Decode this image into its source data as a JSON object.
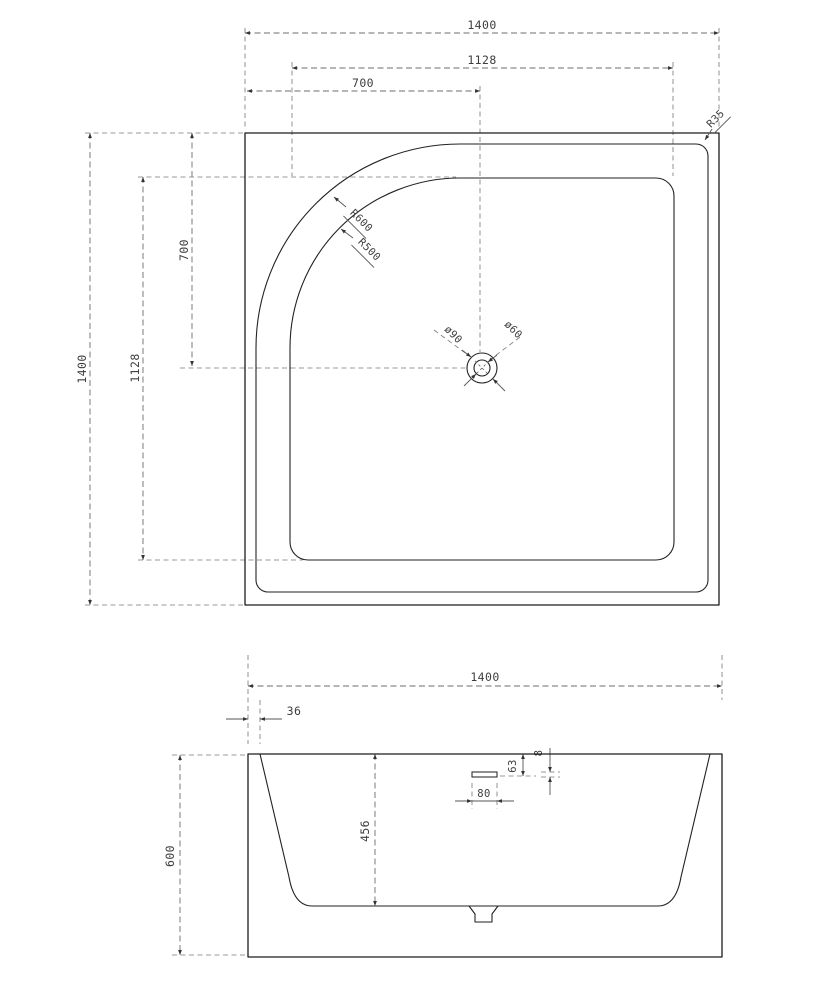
{
  "drawing": {
    "kind": "shower-tray technical drawing, plan view and front section",
    "colors": {
      "background": "#ffffff",
      "object_line": "#1c1c1c",
      "dimension_line": "#6d6d6d",
      "text": "#3e3e3e"
    }
  },
  "top_view": {
    "dim_width_overall": "1400",
    "dim_width_inner": "1128",
    "dim_width_to_drain": "700",
    "dim_height_overall": "1400",
    "dim_height_inner": "1128",
    "dim_height_to_drain": "700",
    "label_corner_radius": "R35",
    "label_outer_arc_radius": "R600",
    "label_inner_arc_radius": "R500",
    "label_drain_outer_dia": "ø90",
    "label_drain_inner_dia": "ø60"
  },
  "front_view": {
    "dim_width_overall": "1400",
    "dim_rim_inset": "36",
    "dim_height_overall": "600",
    "dim_basin_depth": "456",
    "dim_overflow_offset": "63",
    "dim_overflow_height": "8",
    "dim_overflow_width": "80"
  }
}
